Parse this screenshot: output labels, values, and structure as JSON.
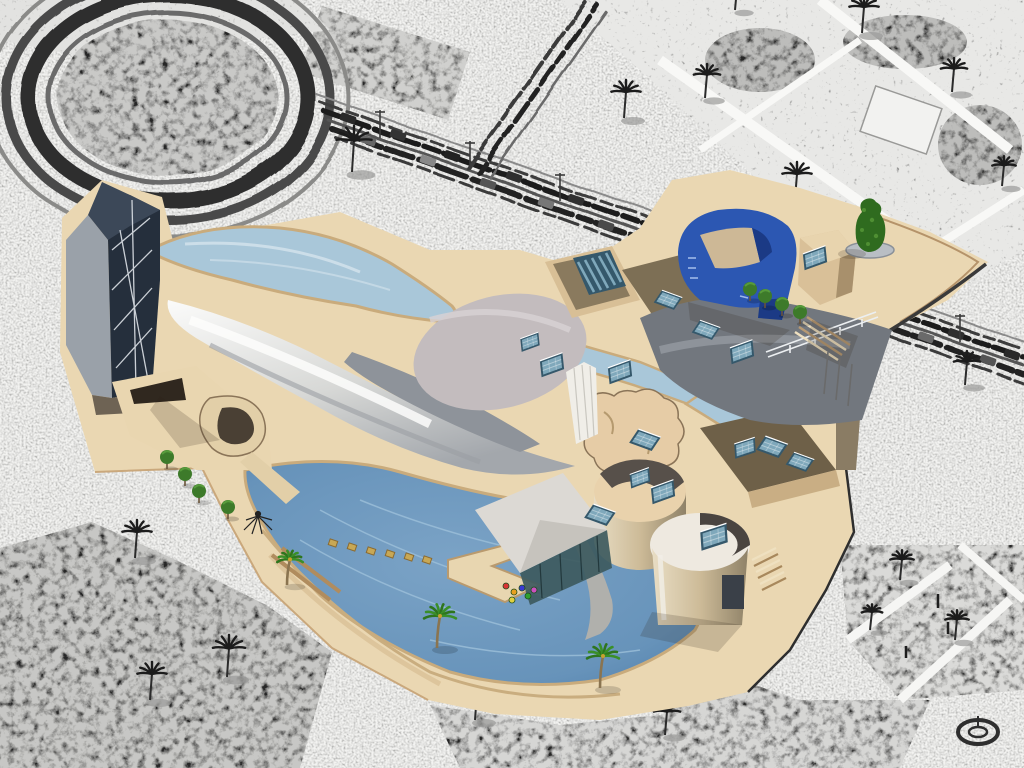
{
  "scene": {
    "type": "isometric-city-game-view",
    "landmark": "guggenheim-style-museum",
    "render_style": "surroundings-pencil-sketch-landmark-full-color",
    "hud_text": ""
  },
  "palette": {
    "bg": "#f3f3f1",
    "sketchInk": "#262626",
    "sketchMid": "#8f8f8d",
    "sketchLight": "#e7e7e5",
    "gardenBase": "#cfcfcd",
    "plaza": "#ead7b2",
    "plazaShade": "#d9bf96",
    "pathEdge": "#c2a074",
    "waterLight": "#a9c7d9",
    "waterDeep": "#places",
    "lagoon": "#6793ba",
    "lagoonDeep": "#4d7ca8",
    "ripple": "#9dc0da",
    "silver": "#f2f1ef",
    "silverShade": "#a9adb2",
    "metal": "#72777e",
    "metalLight": "#9aa0a6",
    "stucco": "#e6cca6",
    "stuccoShade": "#b59a6f",
    "brownRoof": "#7d6f55",
    "brownWall": "#d8bf96",
    "brownDark": "#6a5a42",
    "skylightBlue": "#7fa8bb",
    "skylightFrame": "#35586b",
    "cobalt": "#2c57b2",
    "cobaltDark": "#1b3a85",
    "towerDark": "#252f3c",
    "towerMid": "#3c4858",
    "towerLight": "#9aa1a9",
    "truss": "#dde2e7",
    "green": "#3a8f28",
    "greenDark": "#2e751d",
    "trunk": "#8a7450",
    "canopy": "#dcd9d4",
    "glass": "#3d5a5e"
  },
  "objects": {
    "sketch_palms": [
      [
        352,
        172,
        1.2
      ],
      [
        624,
        118,
        1
      ],
      [
        705,
        98,
        0.9
      ],
      [
        795,
        200,
        1
      ],
      [
        862,
        33,
        1
      ],
      [
        952,
        92,
        0.9
      ],
      [
        1002,
        186,
        0.8
      ],
      [
        735,
        10,
        0.8
      ],
      [
        965,
        385,
        0.9
      ],
      [
        135,
        558,
        1
      ],
      [
        290,
        598,
        0.9
      ],
      [
        227,
        677,
        1.1
      ],
      [
        475,
        720,
        1
      ],
      [
        665,
        735,
        0.9
      ],
      [
        900,
        580,
        0.8
      ],
      [
        955,
        640,
        0.8
      ],
      [
        870,
        630,
        0.7
      ],
      [
        150,
        700,
        1
      ]
    ],
    "cars": [
      [
        348,
        -8,
        "#2a2a2a"
      ],
      [
        368,
        7,
        "#666666"
      ],
      [
        398,
        -9,
        "#333333"
      ],
      [
        428,
        6,
        "#888888"
      ],
      [
        452,
        -7,
        "#222222"
      ],
      [
        488,
        8,
        "#555555"
      ],
      [
        514,
        -8,
        "#2f2f2f"
      ],
      [
        546,
        7,
        "#777777"
      ],
      [
        576,
        -7,
        "#303030"
      ],
      [
        606,
        8,
        "#4a4a4a"
      ],
      [
        896,
        -8,
        "#2a2a2a"
      ],
      [
        926,
        7,
        "#6a6a6a"
      ],
      [
        956,
        -7,
        "#303030"
      ],
      [
        988,
        8,
        "#555555"
      ],
      [
        1012,
        -6,
        "#2a2a2a"
      ]
    ],
    "lamps": [
      [
        380,
        110
      ],
      [
        470,
        141
      ],
      [
        560,
        173
      ],
      [
        900,
        293
      ],
      [
        960,
        314
      ]
    ],
    "color_palms": [
      [
        437,
        648,
        1
      ],
      [
        600,
        688,
        1
      ],
      [
        287,
        585,
        0.8
      ]
    ],
    "round_trees": [
      [
        167,
        463
      ],
      [
        185,
        480
      ],
      [
        199,
        497
      ],
      [
        228,
        513
      ],
      [
        750,
        295
      ],
      [
        765,
        302
      ],
      [
        782,
        310
      ],
      [
        800,
        318
      ]
    ],
    "skylights": [
      [
        552,
        365,
        -20,
        1
      ],
      [
        620,
        372,
        -20,
        1
      ],
      [
        645,
        440,
        20,
        1
      ],
      [
        663,
        492,
        -20,
        1
      ],
      [
        600,
        515,
        20,
        1
      ],
      [
        714,
        537,
        -18,
        1.15
      ],
      [
        742,
        352,
        -20,
        1
      ],
      [
        772,
        447,
        20,
        1
      ],
      [
        668,
        300,
        20,
        0.9
      ],
      [
        706,
        330,
        20,
        0.9
      ],
      [
        815,
        258,
        -20,
        1
      ],
      [
        745,
        448,
        -18,
        0.9
      ],
      [
        800,
        462,
        20,
        0.9
      ],
      [
        640,
        478,
        -20,
        0.85
      ],
      [
        530,
        342,
        -20,
        0.8
      ]
    ],
    "stepping_stones": [
      [
        333,
        543
      ],
      [
        352,
        547
      ],
      [
        371,
        551
      ],
      [
        390,
        554
      ],
      [
        409,
        557
      ],
      [
        427,
        560
      ]
    ],
    "flowers": [
      [
        506,
        586,
        "#d83535"
      ],
      [
        514,
        592,
        "#e8a020"
      ],
      [
        522,
        588,
        "#3a3ad0"
      ],
      [
        528,
        596,
        "#2fa02f"
      ],
      [
        534,
        590,
        "#cc4fc0"
      ],
      [
        512,
        600,
        "#e0d040"
      ]
    ],
    "flagpoles": [
      [
        828,
        352
      ],
      [
        840,
        358
      ],
      [
        852,
        364
      ]
    ],
    "truss_lines": [
      [
        112,
        250,
        150,
        218
      ],
      [
        112,
        290,
        152,
        250
      ],
      [
        114,
        330,
        152,
        288
      ],
      [
        116,
        368,
        152,
        328
      ],
      [
        132,
        200,
        136,
        390
      ],
      [
        120,
        230,
        148,
        380
      ]
    ]
  }
}
